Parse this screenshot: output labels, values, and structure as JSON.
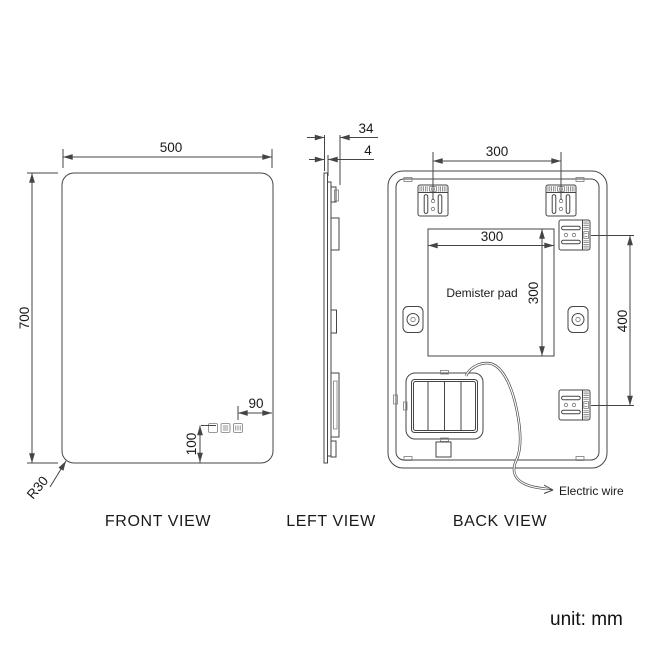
{
  "unit_label": "unit: mm",
  "front_view": {
    "label": "FRONT VIEW",
    "width_mm": "500",
    "height_mm": "700",
    "corner_radius": "R30",
    "controls_right_offset_mm": "90",
    "controls_bottom_offset_mm": "100"
  },
  "left_view": {
    "label": "LEFT VIEW",
    "total_depth_mm": "34",
    "glass_thickness_mm": "4"
  },
  "back_view": {
    "label": "BACK VIEW",
    "bracket_spacing_mm": "300",
    "demister_width_mm": "300",
    "demister_height_mm": "300",
    "bracket_vertical_spacing_mm": "400",
    "demister_pad_label": "Demister pad",
    "electric_wire_label": "Electric wire"
  },
  "colors": {
    "line": "#454545",
    "detail_line": "#7a7a7a",
    "text": "#1a1a1a",
    "background": "#ffffff"
  }
}
